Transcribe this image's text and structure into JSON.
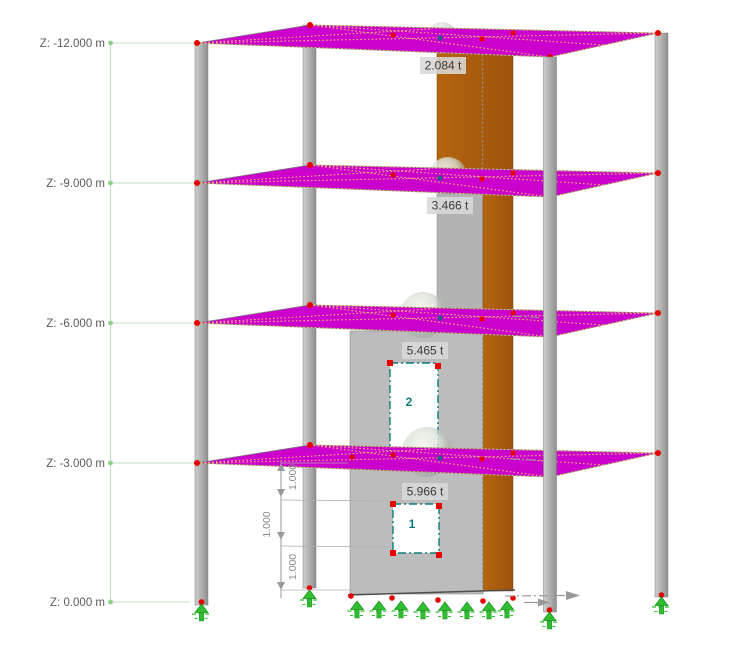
{
  "scene": {
    "title": "structural-model-viewport",
    "levels": [
      {
        "id": "z-12",
        "label": "Z: -12.000 m"
      },
      {
        "id": "z-9",
        "label": "Z: -9.000 m"
      },
      {
        "id": "z-6",
        "label": "Z: -6.000 m"
      },
      {
        "id": "z-3",
        "label": "Z: -3.000 m"
      },
      {
        "id": "z-0",
        "label": "Z: 0.000 m"
      }
    ],
    "masses": [
      {
        "level": "z-12",
        "label": "2.084 t"
      },
      {
        "level": "z-9",
        "label": "3.466 t"
      },
      {
        "level": "z-6",
        "label": "5.465 t"
      },
      {
        "level": "z-3",
        "label": "5.966 t"
      }
    ],
    "openings": [
      {
        "number": "2"
      },
      {
        "number": "1"
      }
    ],
    "dimensions": [
      {
        "label": "1.000"
      },
      {
        "label": "1.000"
      },
      {
        "label": "1.000"
      }
    ],
    "colors": {
      "slab": "#cc00cc",
      "slab_mesh": "#f6b87c",
      "wall_front": "#bcbcbc",
      "wall_front_upper": "#b3b3b3",
      "wall_side": "#a95c0e",
      "column": "#aeaeae",
      "support": "#2fbe2f",
      "node": "#e60000",
      "opening_border": "#0d7d7d",
      "guide": "#c2e0c2",
      "label_text": "#5a5a5a",
      "mass_label_bg": "#d8d8d8",
      "background": "#ffffff"
    }
  }
}
